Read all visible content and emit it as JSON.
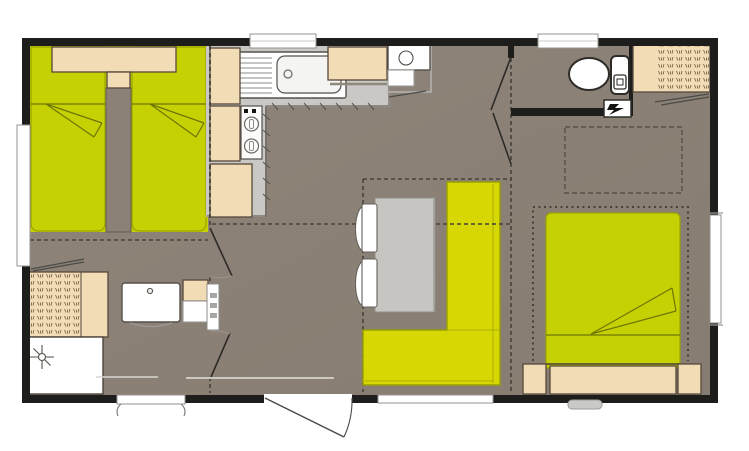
{
  "title": "mobile-home-floor-plan",
  "colors": {
    "wall": "#1d1d1b",
    "floor": "#8c8177",
    "bed": "#c6d103",
    "sofa": "#d7d704",
    "beige": "#f2dcb6",
    "counter": "#c9c8c4",
    "white": "#ffffff",
    "table": "#c6c5c2"
  },
  "plan": {
    "rooms": [
      {
        "name": "twin-bedroom",
        "furniture": [
          "single-bed",
          "single-bed",
          "headboard-shelf",
          "center-console"
        ]
      },
      {
        "name": "kitchen",
        "furniture": [
          "sink-with-drainer",
          "two-burner-stove",
          "base-cabinets",
          "fridge-appliance"
        ]
      },
      {
        "name": "living-dinette",
        "furniture": [
          "l-shaped-sofa",
          "dining-table",
          "chair",
          "chair"
        ]
      },
      {
        "name": "wc",
        "furniture": [
          "toilet",
          "electrical-panel"
        ]
      },
      {
        "name": "double-bedroom",
        "furniture": [
          "double-bed",
          "headboard",
          "nightstand",
          "nightstand",
          "wardrobe",
          "overhead-storage",
          "skylight"
        ]
      },
      {
        "name": "shower-room",
        "furniture": [
          "wardrobe",
          "shower",
          "washbasin",
          "cabinet",
          "radiator"
        ]
      }
    ],
    "openings": [
      "entrance-door",
      "interior-door-x4",
      "window-x6",
      "vent"
    ]
  }
}
